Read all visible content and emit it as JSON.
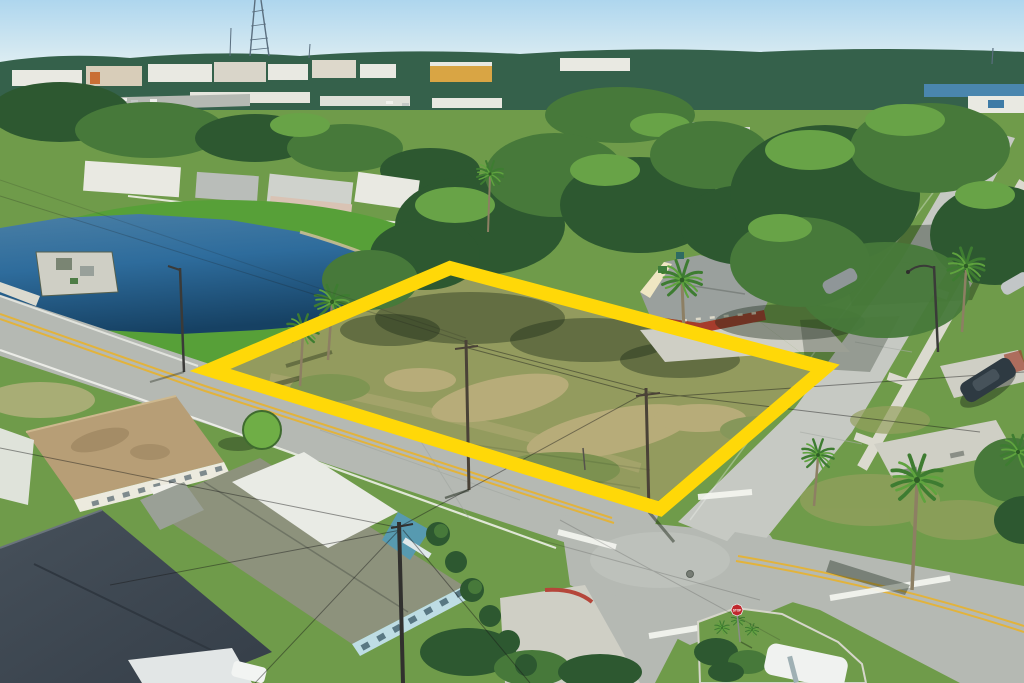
{
  "scene": {
    "description": "Aerial drone photograph of a vacant corner lot highlighted with a thick yellow boundary at a residential street intersection, with a retention pond at upper left, single-family homes at lower left, a red brick house beside the lot, tree canopy, and a stop-sign island at the bottom"
  },
  "signs": {
    "stop_label": "STOP"
  },
  "highlight": {
    "lot_outline_points": "450,268 825,368 660,509 210,370",
    "lot_outline_color": "#FFD808"
  },
  "palette": {
    "sky_top": "#aed6ee",
    "sky_horizon": "#e9f3f3",
    "horizon_trees": "#35614b",
    "tree_dark": "#2d5830",
    "tree_mid": "#47793a",
    "tree_light": "#68a347",
    "grass_bright": "#57a038",
    "grass_mid": "#6f9b4a",
    "grass_dry": "#95a05f",
    "grass_pale": "#c0b588",
    "lot_base": "#939b5e",
    "lot_sand": "#b7ac79",
    "pond_deep": "#164163",
    "pond_mid": "#2e6c9c",
    "pond_light": "#4a7fa5",
    "sand_rim": "#c9bd93",
    "road": "#b5b9b3",
    "road_light": "#c6c9c3",
    "sidewalk": "#dbdacf",
    "concrete": "#cfcfc5",
    "line_yellow": "#e2b33c",
    "line_white": "#f4f5f0",
    "roof_gray": "#8d927c",
    "roof_dark_a": "#46505a",
    "roof_dark_b": "#353e48",
    "roof_tan": "#b79e76",
    "roof_metal": "#e9ebe5",
    "wall_blue": "#bedde4",
    "wall_teal": "#579ab0",
    "brick_red": "#a63c2c",
    "gable_cream": "#efe6c2",
    "bldg_white": "#e9e9e2",
    "bldg_yellow": "#d9a544",
    "water_far": "#4a86ae",
    "palm_trunk": "#8d7f63",
    "palm_frond": "#3e7c31",
    "palm_frond_light": "#5fa33e",
    "stop_red": "#c0272d",
    "car_dark": "#2e3a42",
    "car_silver": "#c2c6c7",
    "car_white": "#f0f2f0",
    "pole_brown": "#4a4237",
    "wire": "rgba(25,25,25,0.45)",
    "shadow": "rgba(22,36,20,0.38)",
    "curb_red": "#b5463a"
  }
}
